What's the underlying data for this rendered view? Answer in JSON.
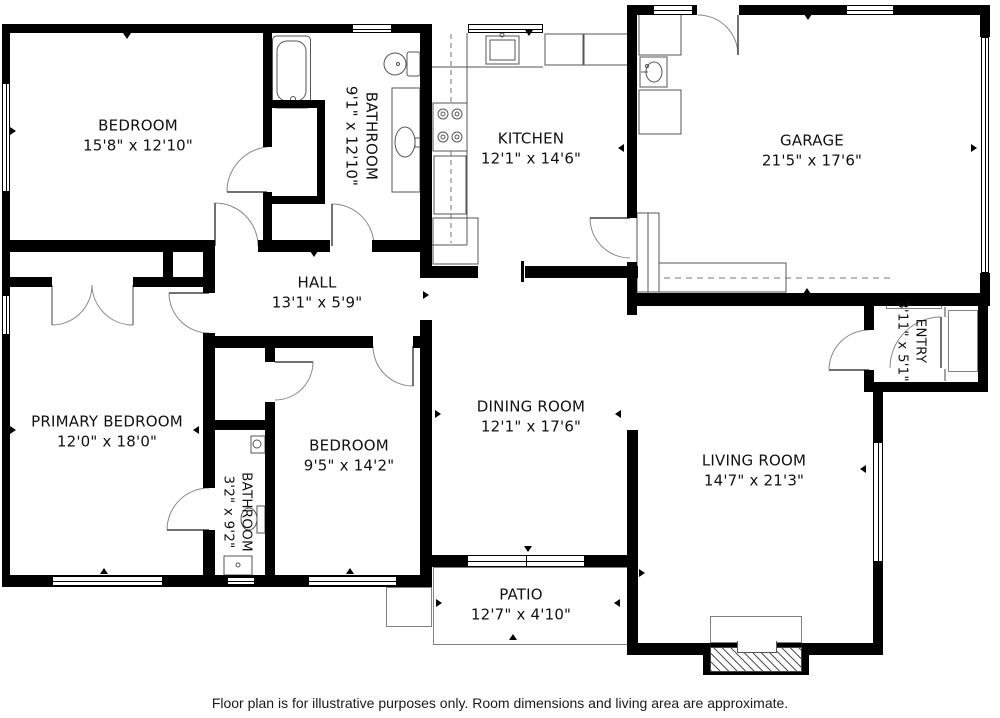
{
  "footer": {
    "disclaimer": "Floor plan is for illustrative purposes only. Room dimensions and living area are approximate."
  },
  "rooms": [
    {
      "key": "bedroom-top",
      "name": "BEDROOM",
      "dims": "15'8\" x 12'10\""
    },
    {
      "key": "bathroom-main",
      "name": "BATHROOM",
      "dims": "9'1\" x 12'10\""
    },
    {
      "key": "kitchen",
      "name": "KITCHEN",
      "dims": "12'1\" x 14'6\""
    },
    {
      "key": "garage",
      "name": "GARAGE",
      "dims": "21'5\" x 17'6\""
    },
    {
      "key": "hall",
      "name": "HALL",
      "dims": "13'1\" x 5'9\""
    },
    {
      "key": "primary-bedroom",
      "name": "PRIMARY BEDROOM",
      "dims": "12'0\" x 18'0\""
    },
    {
      "key": "bedroom-2",
      "name": "BEDROOM",
      "dims": "9'5\" x 14'2\""
    },
    {
      "key": "bathroom-2",
      "name": "BATHROOM",
      "dims": "3'2\" x 9'2\""
    },
    {
      "key": "dining-room",
      "name": "DINING ROOM",
      "dims": "12'1\" x 17'6\""
    },
    {
      "key": "living-room",
      "name": "LIVING ROOM",
      "dims": "14'7\" x 21'3\""
    },
    {
      "key": "entry",
      "name": "ENTRY",
      "dims": "3'11\" x 5'1\""
    },
    {
      "key": "patio",
      "name": "PATIO",
      "dims": "12'7\" x 4'10\""
    }
  ],
  "fixtures": [
    "bathtub",
    "toilet",
    "vanity-sink",
    "kitchen-sink",
    "stove",
    "refrigerator",
    "dishwasher",
    "washer",
    "dryer",
    "utility-sink",
    "workbench",
    "fireplace",
    "patio-steps",
    "sliding-door",
    "entry-step",
    "garage-door"
  ],
  "colors": {
    "wall": "#000000",
    "fixture_line": "#555555",
    "thin_line": "#808080",
    "background": "#ffffff"
  }
}
